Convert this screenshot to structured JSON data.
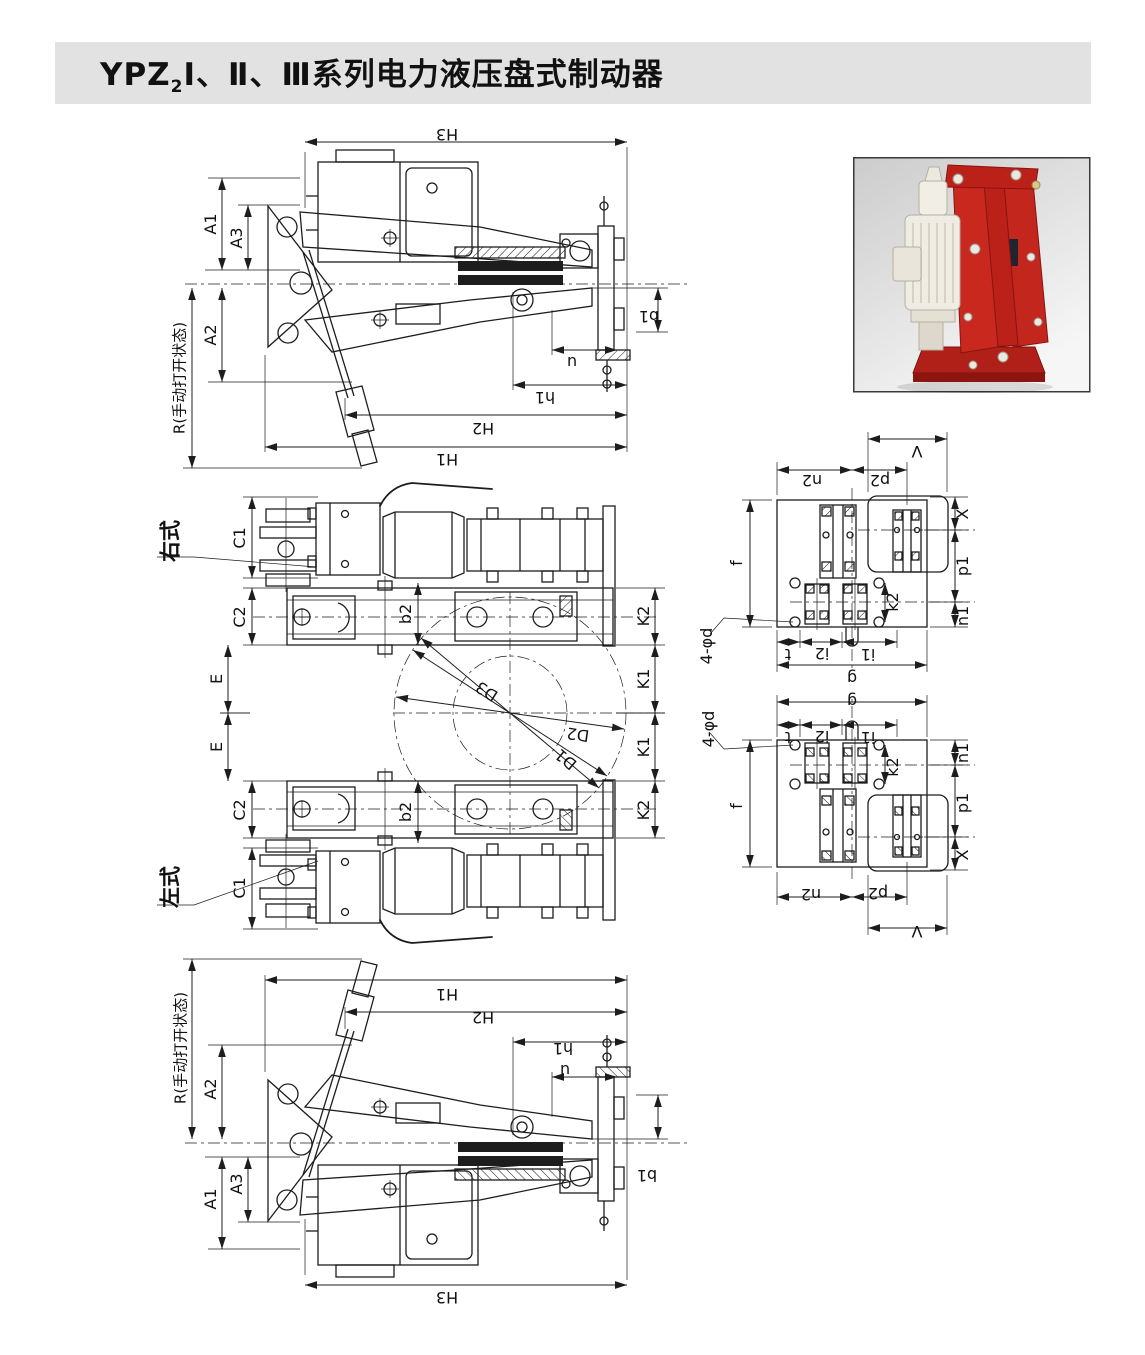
{
  "header": {
    "model": "YPZ",
    "model_subscript": "2",
    "series_suffix": "Ⅰ、Ⅱ、Ⅲ系列电力液压盘式制动器"
  },
  "views": {
    "side": {
      "H1": "H1",
      "H2": "H2",
      "H3": "H3",
      "h1": "h1",
      "u": "u",
      "b1": "b1",
      "A1": "A1",
      "A2": "A2",
      "A3": "A3",
      "R_open": "R(手动打开状态)"
    },
    "plan": {
      "right_type": "右式",
      "left_type": "左式",
      "C1": "C1",
      "C2": "C2",
      "E": "E",
      "b2": "b2",
      "K1": "K1",
      "K2": "K2"
    },
    "disc": {
      "D1": "D1",
      "D2": "D2",
      "D3": "D3"
    },
    "plate": {
      "V": "V",
      "n2": "n2",
      "p2": "p2",
      "f": "f",
      "X": "X",
      "p1": "p1",
      "k2": "k2",
      "n1": "n1",
      "t": "t",
      "i2": "i2",
      "i1": "i1",
      "g": "g",
      "holes": "4-φd"
    }
  },
  "colors": {
    "title_bar_bg": "#e2e2e2",
    "drawing_line": "#1d1d1d",
    "brake_red": "#c2261d",
    "brake_red_dark": "#8e130e",
    "thruster_ivory": "#efece3",
    "photo_border": "#3a3a3a"
  }
}
